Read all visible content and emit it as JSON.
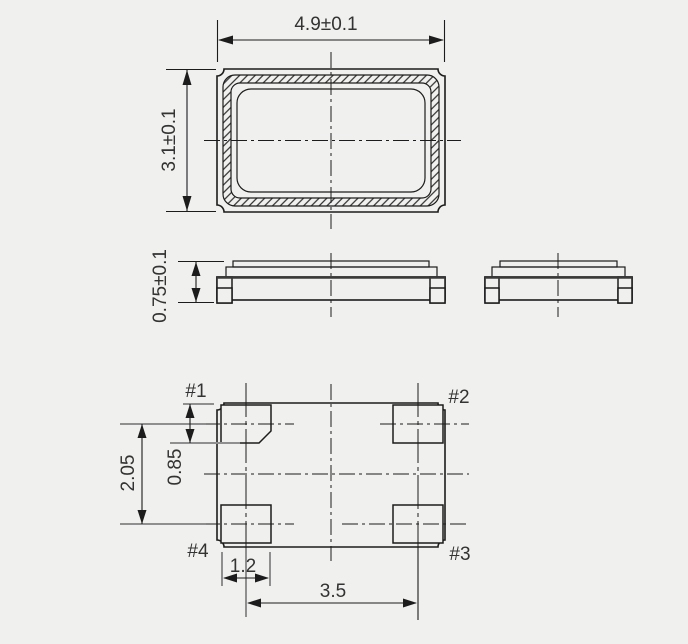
{
  "colors": {
    "background": "#f0f0ee",
    "line": "#1c1c1c",
    "gray_line": "#8f8f8f",
    "text": "#333333"
  },
  "views": {
    "top": {
      "width_dim": "4.9±0.1",
      "height_dim": "3.1±0.1"
    },
    "side": {
      "height_dim": "0.75±0.1"
    },
    "bottom": {
      "pads": [
        {
          "label": "#1"
        },
        {
          "label": "#2"
        },
        {
          "label": "#3"
        },
        {
          "label": "#4"
        }
      ],
      "row_pitch_dim": "2.05",
      "pad_height_dim": "0.85",
      "pad_width_dim": "1.2",
      "col_pitch_dim": "3.5"
    }
  }
}
